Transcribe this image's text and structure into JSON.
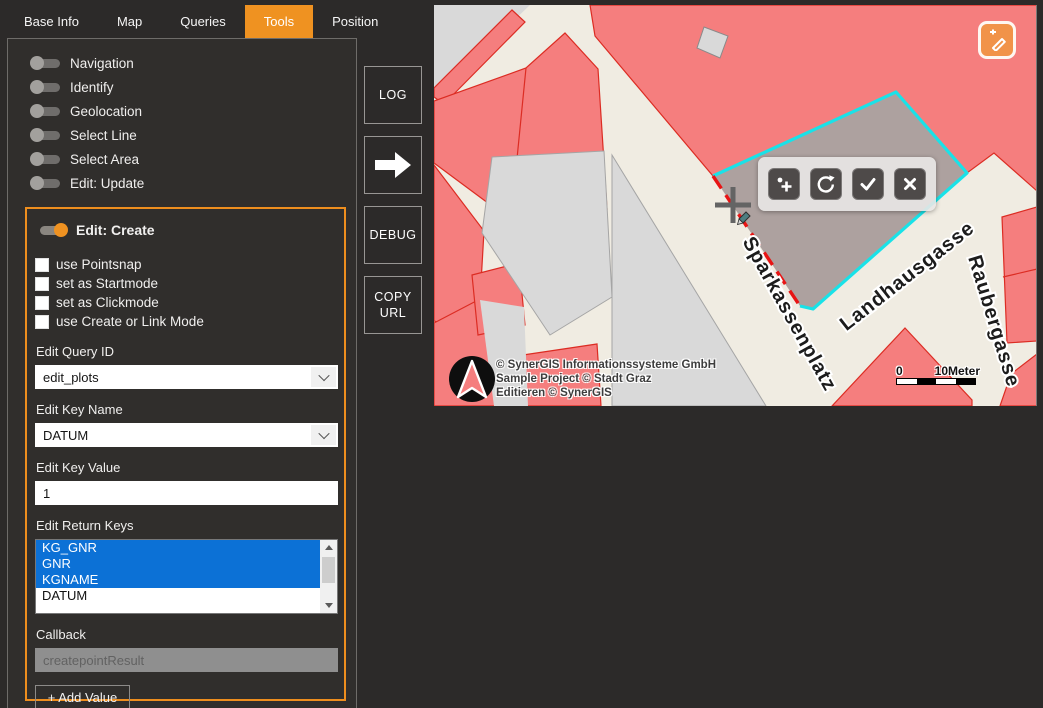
{
  "colors": {
    "accent_orange": "#EF9221",
    "selection_blue": "#0C71D6",
    "map_pink": "#F57E7E",
    "map_red_border": "#DC2C23",
    "map_cream": "#F0ECE2",
    "map_gray": "#D9D9D9",
    "parcel_cyan": "#19E2E8",
    "sketch_red": "#E81414"
  },
  "tabs": {
    "items": [
      {
        "label": "Base Info",
        "active": false
      },
      {
        "label": "Map",
        "active": false
      },
      {
        "label": "Queries",
        "active": false
      },
      {
        "label": "Tools",
        "active": true
      },
      {
        "label": "Position",
        "active": false
      }
    ]
  },
  "sidebar": {
    "toggles": [
      {
        "label": "Navigation",
        "on": false
      },
      {
        "label": "Identify",
        "on": false
      },
      {
        "label": "Geolocation",
        "on": false
      },
      {
        "label": "Select Line",
        "on": false
      },
      {
        "label": "Select Area",
        "on": false
      },
      {
        "label": "Edit: Update",
        "on": false
      }
    ],
    "group": {
      "toggle_label": "Edit: Create",
      "on": true,
      "checkboxes": [
        {
          "label": "use Pointsnap",
          "checked": false
        },
        {
          "label": "set as Startmode",
          "checked": false
        },
        {
          "label": "set as Clickmode",
          "checked": false
        },
        {
          "label": "use Create or Link Mode",
          "checked": false
        }
      ],
      "fields": {
        "query_id": {
          "label": "Edit Query ID",
          "value": "edit_plots"
        },
        "key_name": {
          "label": "Edit Key Name",
          "value": "DATUM"
        },
        "key_value": {
          "label": "Edit Key Value",
          "value": "1"
        },
        "return_keys": {
          "label": "Edit Return Keys",
          "options": [
            {
              "label": "KG_GNR",
              "selected": true
            },
            {
              "label": "GNR",
              "selected": true
            },
            {
              "label": "KGNAME",
              "selected": true
            },
            {
              "label": "DATUM",
              "selected": false
            }
          ]
        },
        "callback": {
          "label": "Callback",
          "value": "createpointResult",
          "disabled": true
        }
      },
      "add_button_label": "+ Add Value"
    }
  },
  "action_buttons": {
    "log": "LOG",
    "arrow_icon": "arrow-right",
    "debug": "DEBUG",
    "copy_url": "COPY URL"
  },
  "map": {
    "street_labels": [
      "Sparkassenplatz",
      "Landhausgasse",
      "Raubergasse"
    ],
    "copyright_lines": [
      "© SynerGIS Informationssysteme GmbH",
      "Sample Project © Stadt Graz",
      "Editieren © SynerGIS"
    ],
    "scale": {
      "start": "0",
      "end": "10Meter"
    },
    "toolbar_icons": [
      "add-point",
      "rotate",
      "confirm",
      "cancel"
    ],
    "corner_icon": "edit-create"
  }
}
